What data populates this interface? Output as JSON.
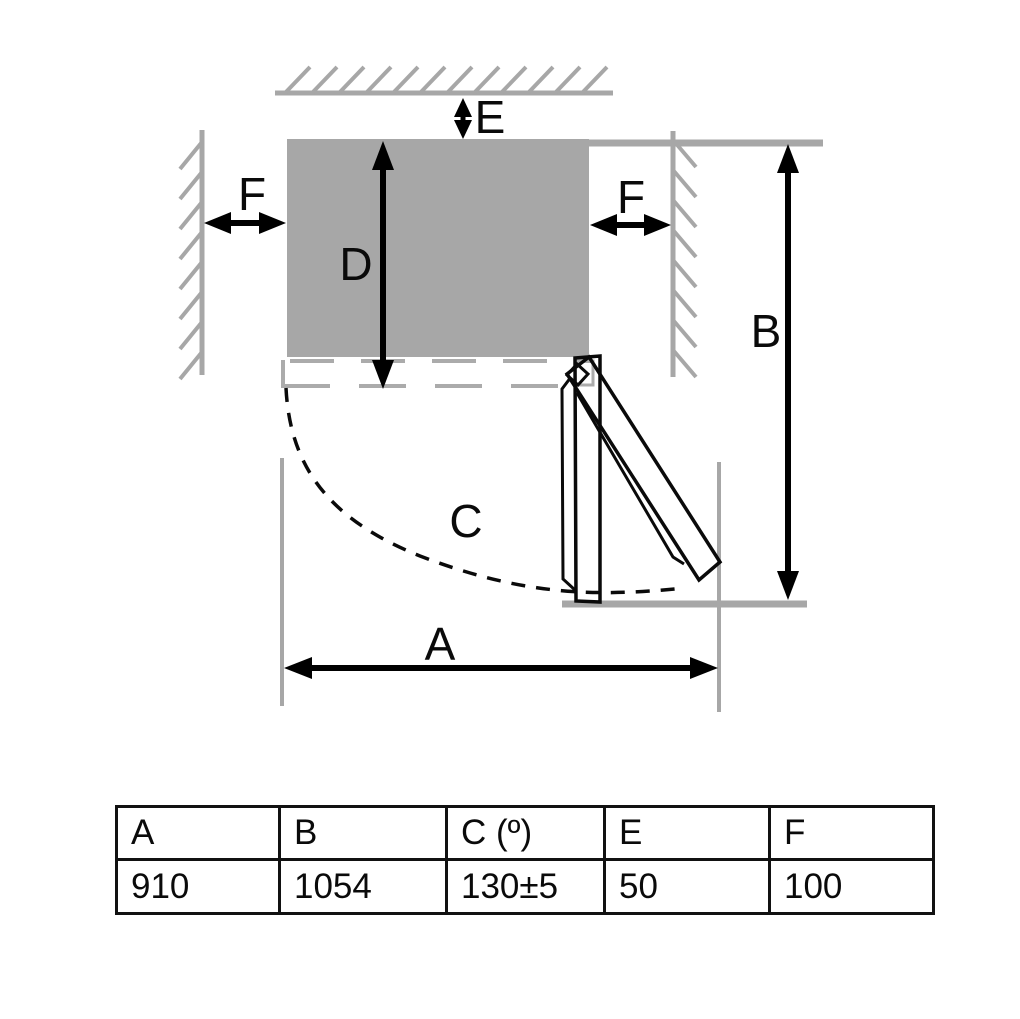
{
  "diagram": {
    "dimension_labels": {
      "A": "A",
      "B": "B",
      "C": "C",
      "D": "D",
      "E": "E",
      "F_left": "F",
      "F_right": "F"
    }
  },
  "table": {
    "headers": [
      "A",
      "B",
      "C (º)",
      "E",
      "F"
    ],
    "values": [
      "910",
      "1054",
      "130±5",
      "50",
      "100"
    ]
  },
  "colors": {
    "wall_gray": "#a7a7a7",
    "cabinet_gray": "#a7a7a7",
    "dashed_gray": "#b0b0b0",
    "ink_black": "#0a0a0a"
  }
}
